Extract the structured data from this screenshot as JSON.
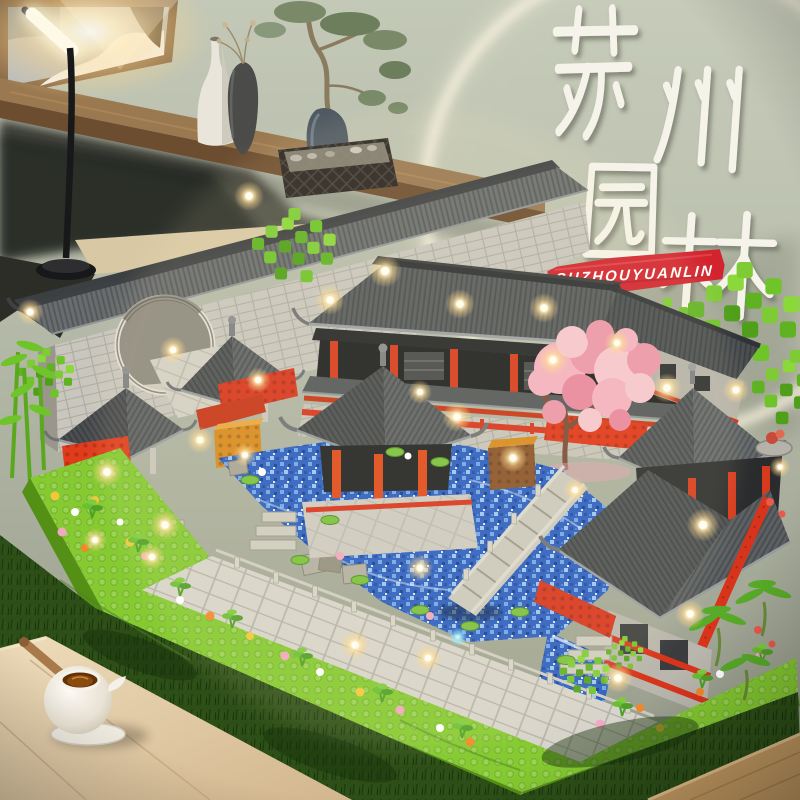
{
  "meta": {
    "description": "Product photo: Suzhou classical garden micro building-block model with LED lights, displayed on a wooden desk with shelf decor, desk lamp and glowing wall ring"
  },
  "overlay": {
    "calligraphy": {
      "text": "苏州园林",
      "characters": [
        "苏",
        "州",
        "园",
        "林"
      ],
      "style": "white brush calligraphy",
      "color": "#f5f3ea"
    },
    "banner": {
      "text": "SUZHOUYUANLIN",
      "background_color": "#d2232e",
      "text_color": "#ffffff"
    }
  },
  "scene": {
    "background": {
      "wall_color": "#b4baa9",
      "ring_light_color": "#f5eeda"
    },
    "shelf": {
      "wood_color": "#8a6844",
      "items": [
        "framed snow painting",
        "white bottle vase",
        "dark vase with dried sprigs",
        "scholar stone with bonsai tree",
        "black lattice pebble tray",
        "hanging foliage"
      ]
    },
    "desk_lamp": {
      "state": "on",
      "glow_color": "#fff3cf"
    },
    "model": {
      "type": "micro building-block garden set",
      "elements": [
        "long gray wall with moon gate",
        "two gazebos",
        "main hall with red columns",
        "large front pavilion",
        "two-tier tower",
        "pink cherry blossom tree",
        "green block trees and bamboo",
        "blue brick pond with lily pads",
        "stone stair bridge",
        "lime flower borders",
        "white tile paths",
        "warm LED lights"
      ],
      "colors": {
        "roof": "#54585a",
        "wall": "#c9c6bd",
        "red": "#d8341c",
        "orange": "#d8891e",
        "green": "#6ec428",
        "lime": "#84ca30",
        "water": "#2a5ec2",
        "blossom": "#f2aab8",
        "light": "#ffe9a8"
      }
    },
    "foreground": {
      "items": [
        "moss grass strip",
        "white teapot with wooden handle on saucer",
        "light wooden table",
        "wooden table corner"
      ]
    }
  }
}
